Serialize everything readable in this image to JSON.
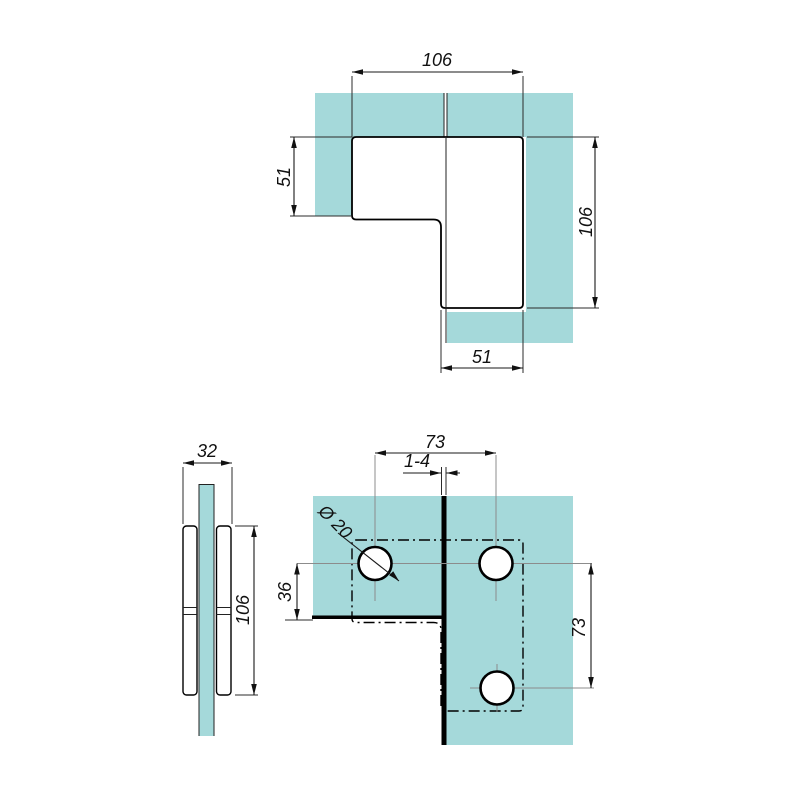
{
  "drawing": {
    "background": "#ffffff",
    "glass_color": "#a5d9da",
    "line_color": "#000000",
    "centerline_color": "#8c8c8c"
  },
  "views": {
    "top": {
      "dims": {
        "top_width": "106",
        "left_height": "51",
        "right_height": "106",
        "bottom_width": "51"
      }
    },
    "side": {
      "dims": {
        "assembly_width": "32",
        "plate_height": "106"
      }
    },
    "front": {
      "dims": {
        "hole_spacing_horizontal": "73",
        "glass_gap": "1-4",
        "hole_diameter": "Ø 20",
        "hole_edge_offset": "36",
        "hole_spacing_vertical": "73"
      }
    }
  }
}
